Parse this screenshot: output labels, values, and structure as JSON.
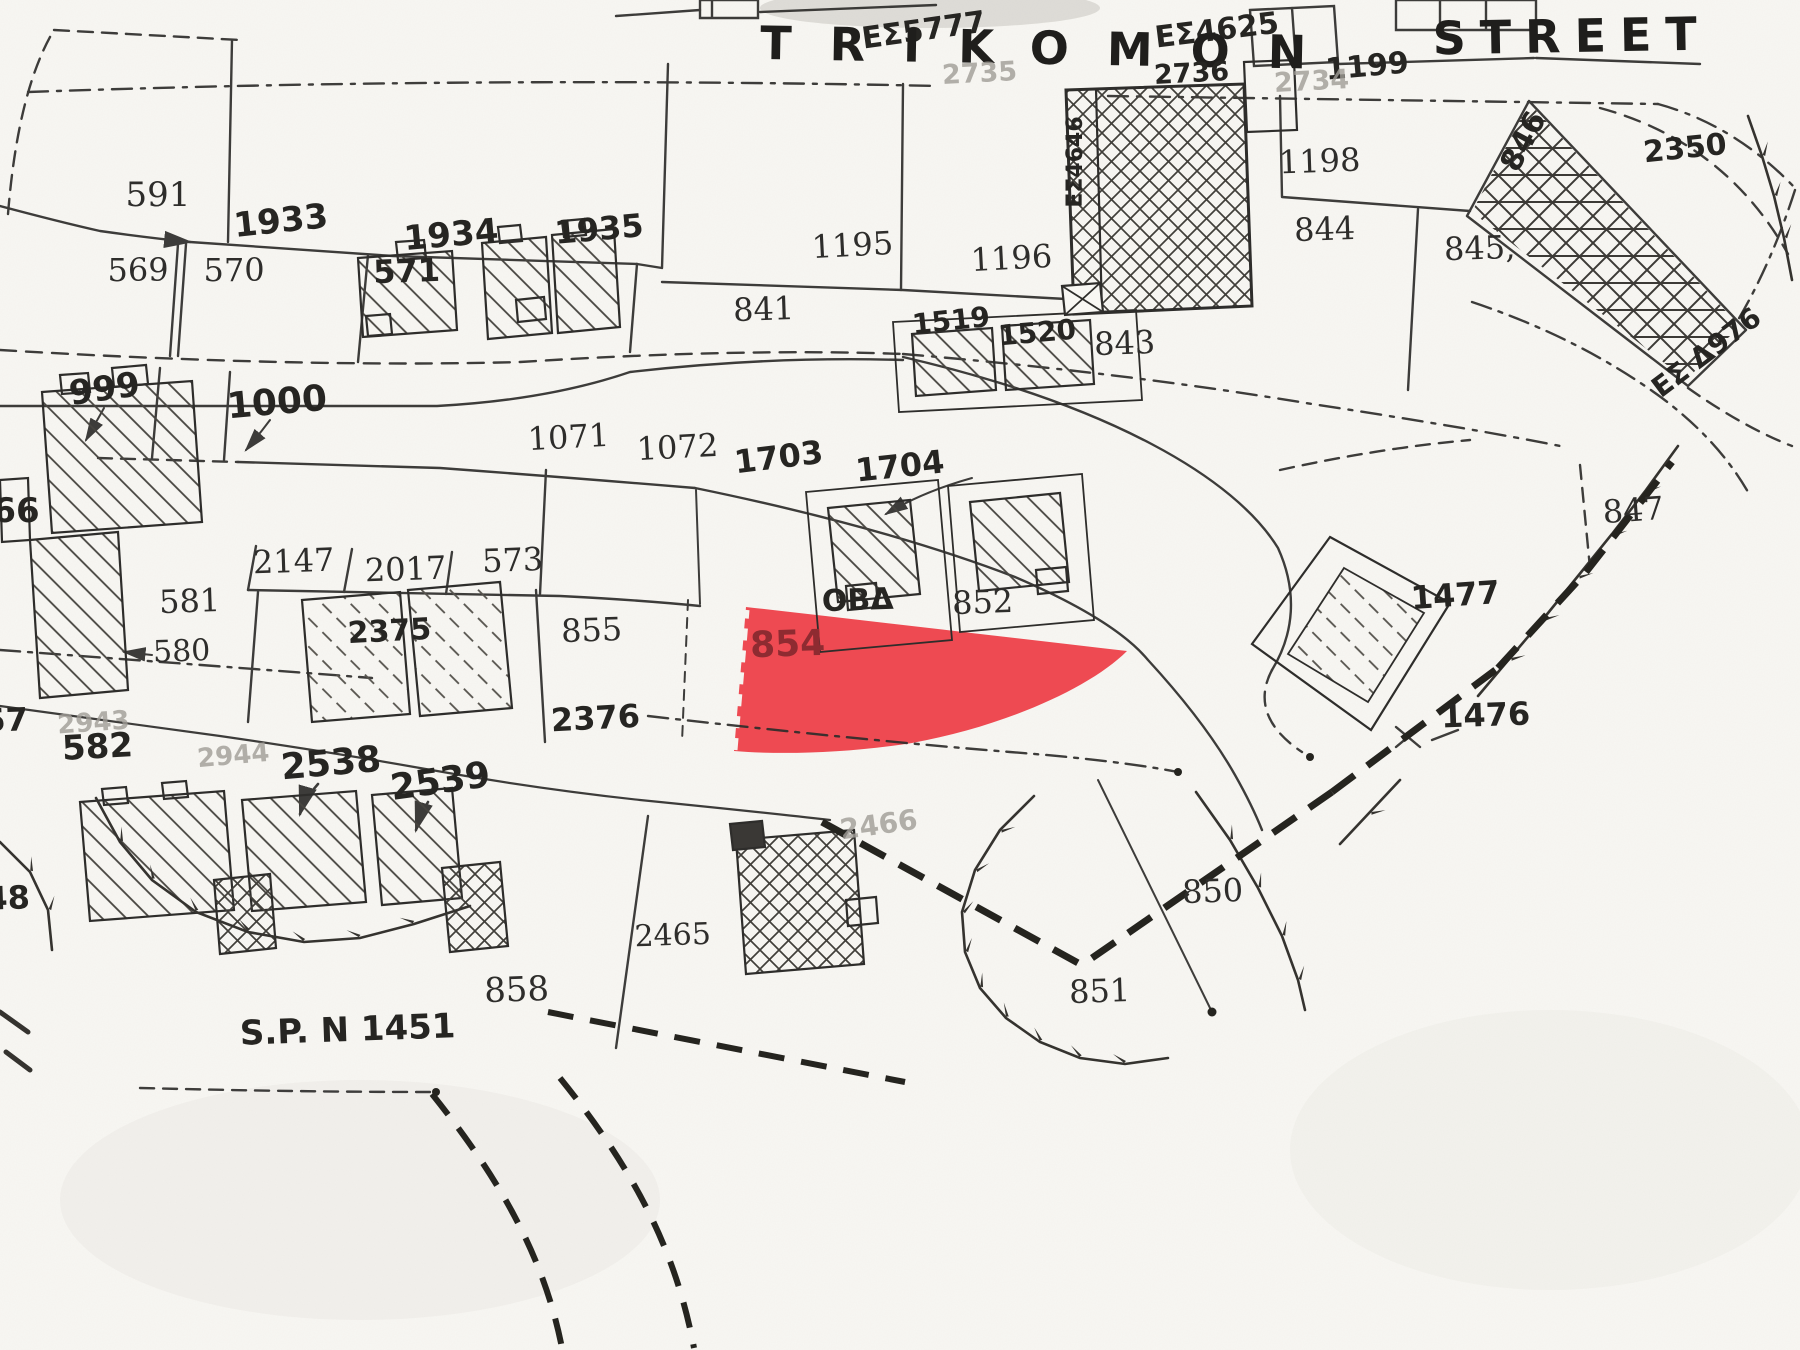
{
  "map": {
    "type": "cadastral-survey-plan",
    "street": {
      "name": "TRIKOMON STREET",
      "word1": "TRIKOMON",
      "word2": "STREET",
      "plot_between_words": "1199"
    },
    "survey_plan_ref": "S.P. N 1451",
    "highlight": {
      "plot_number": "854",
      "fill": "#ee4a52",
      "label_color": "#8e2b31"
    },
    "annotations": [
      "ΕΣ5777",
      "ΕΣ4625",
      "ΕΣ4646",
      "ΕΣ Δ976"
    ],
    "faint_plot_numbers": [
      "2735",
      "2734",
      "2943",
      "2944",
      "2466"
    ],
    "labels": [
      {
        "t": "ΕΣ5777",
        "x": 925,
        "y": 40,
        "r": -8,
        "c": "hand",
        "s": 30
      },
      {
        "t": "ΕΣ4625",
        "x": 1218,
        "y": 40,
        "r": -7,
        "c": "hand",
        "s": 30
      },
      {
        "t": "TRIKOMON",
        "x": 1052,
        "y": 64,
        "r": 1,
        "c": "street",
        "s": 46,
        "ls": 38
      },
      {
        "t": "1199",
        "x": 1368,
        "y": 76,
        "r": -5,
        "c": "hand",
        "s": 30
      },
      {
        "t": "STREET",
        "x": 1572,
        "y": 52,
        "r": -1,
        "c": "street",
        "s": 46,
        "ls": 14
      },
      {
        "t": "2735",
        "x": 980,
        "y": 82,
        "r": -3,
        "c": "faint",
        "s": 27
      },
      {
        "t": "2736",
        "x": 1192,
        "y": 82,
        "r": -3,
        "c": "hand",
        "s": 27
      },
      {
        "t": "2734",
        "x": 1312,
        "y": 90,
        "r": -3,
        "c": "faint",
        "s": 27
      },
      {
        "t": "591",
        "x": 158,
        "y": 206,
        "r": 0,
        "c": "print",
        "s": 34
      },
      {
        "t": "1933",
        "x": 282,
        "y": 232,
        "r": -6,
        "c": "hand",
        "s": 34
      },
      {
        "t": "1934",
        "x": 452,
        "y": 246,
        "r": -5,
        "c": "hand",
        "s": 34
      },
      {
        "t": "1935",
        "x": 600,
        "y": 240,
        "r": -5,
        "c": "hand",
        "s": 32
      },
      {
        "t": "569",
        "x": 138,
        "y": 281,
        "r": 0,
        "c": "print",
        "s": 32
      },
      {
        "t": "570",
        "x": 234,
        "y": 281,
        "r": 0,
        "c": "print",
        "s": 32
      },
      {
        "t": "571",
        "x": 407,
        "y": 282,
        "r": -2,
        "c": "hand",
        "s": 32
      },
      {
        "t": "999",
        "x": 106,
        "y": 400,
        "r": -8,
        "c": "hand",
        "s": 34
      },
      {
        "t": "1000",
        "x": 278,
        "y": 414,
        "r": -5,
        "c": "hand",
        "s": 36
      },
      {
        "t": "1195",
        "x": 853,
        "y": 256,
        "r": -3,
        "c": "print",
        "s": 32
      },
      {
        "t": "1196",
        "x": 1012,
        "y": 269,
        "r": -3,
        "c": "print",
        "s": 32
      },
      {
        "t": "841",
        "x": 764,
        "y": 320,
        "r": -2,
        "c": "print",
        "s": 32
      },
      {
        "t": "1519",
        "x": 952,
        "y": 330,
        "r": -6,
        "c": "hand",
        "s": 28
      },
      {
        "t": "1520",
        "x": 1038,
        "y": 342,
        "r": -5,
        "c": "hand",
        "s": 28
      },
      {
        "t": "843",
        "x": 1125,
        "y": 354,
        "r": -2,
        "c": "print",
        "s": 32
      },
      {
        "t": "1198",
        "x": 1320,
        "y": 172,
        "r": -2,
        "c": "print",
        "s": 32
      },
      {
        "t": "844",
        "x": 1325,
        "y": 240,
        "r": -2,
        "c": "print",
        "s": 32
      },
      {
        "t": "845,",
        "x": 1480,
        "y": 259,
        "r": -2,
        "c": "print",
        "s": 32
      },
      {
        "t": "846",
        "x": 1532,
        "y": 146,
        "r": -62,
        "c": "hand",
        "s": 30
      },
      {
        "t": "2350",
        "x": 1686,
        "y": 158,
        "r": -6,
        "c": "hand",
        "s": 30
      },
      {
        "t": "ΕΣ Δ976",
        "x": 1712,
        "y": 360,
        "r": -37,
        "c": "hand",
        "s": 28
      },
      {
        "t": "ΕΣ4646",
        "x": 1082,
        "y": 162,
        "r": -90,
        "c": "hand",
        "s": 22
      },
      {
        "t": "66",
        "x": 16,
        "y": 522,
        "r": 0,
        "c": "hand",
        "s": 34
      },
      {
        "t": "2147",
        "x": 294,
        "y": 572,
        "r": -2,
        "c": "print",
        "s": 32
      },
      {
        "t": "2017",
        "x": 406,
        "y": 580,
        "r": -2,
        "c": "print",
        "s": 32
      },
      {
        "t": "573",
        "x": 513,
        "y": 571,
        "r": -2,
        "c": "print",
        "s": 32
      },
      {
        "t": "1071",
        "x": 569,
        "y": 448,
        "r": -3,
        "c": "print",
        "s": 32
      },
      {
        "t": "1072",
        "x": 678,
        "y": 458,
        "r": -3,
        "c": "print",
        "s": 32
      },
      {
        "t": "1703",
        "x": 780,
        "y": 468,
        "r": -7,
        "c": "hand",
        "s": 32
      },
      {
        "t": "1704",
        "x": 901,
        "y": 477,
        "r": -6,
        "c": "hand",
        "s": 32
      },
      {
        "t": "847",
        "x": 1634,
        "y": 521,
        "r": -4,
        "c": "print",
        "s": 32
      },
      {
        "t": "1477",
        "x": 1456,
        "y": 606,
        "r": -4,
        "c": "hand",
        "s": 32
      },
      {
        "t": "581",
        "x": 190,
        "y": 612,
        "r": -2,
        "c": "print",
        "s": 32
      },
      {
        "t": "580",
        "x": 182,
        "y": 661,
        "r": -2,
        "c": "print",
        "s": 30
      },
      {
        "t": "2375",
        "x": 390,
        "y": 641,
        "r": -3,
        "c": "hand",
        "s": 30
      },
      {
        "t": "855",
        "x": 592,
        "y": 641,
        "r": -2,
        "c": "print",
        "s": 32
      },
      {
        "t": "ΟΒΔ",
        "x": 858,
        "y": 610,
        "r": -2,
        "c": "hand",
        "s": 30
      },
      {
        "t": "852",
        "x": 983,
        "y": 613,
        "r": -2,
        "c": "print",
        "s": 32
      },
      {
        "t": "854",
        "x": 788,
        "y": 656,
        "r": -2,
        "c": "red",
        "s": 36
      },
      {
        "t": "57",
        "x": 6,
        "y": 731,
        "r": -2,
        "c": "hand",
        "s": 32
      },
      {
        "t": "2943",
        "x": 94,
        "y": 731,
        "r": -4,
        "c": "faint",
        "s": 26
      },
      {
        "t": "582",
        "x": 98,
        "y": 758,
        "r": -3,
        "c": "hand",
        "s": 34
      },
      {
        "t": "2944",
        "x": 234,
        "y": 764,
        "r": -5,
        "c": "faint",
        "s": 26
      },
      {
        "t": "2376",
        "x": 596,
        "y": 729,
        "r": -3,
        "c": "hand",
        "s": 32
      },
      {
        "t": "2538",
        "x": 332,
        "y": 775,
        "r": -5,
        "c": "hand",
        "s": 36
      },
      {
        "t": "2539",
        "x": 442,
        "y": 793,
        "r": -8,
        "c": "hand",
        "s": 36
      },
      {
        "t": "1476",
        "x": 1486,
        "y": 726,
        "r": -2,
        "c": "hand",
        "s": 32
      },
      {
        "t": "48",
        "x": 8,
        "y": 909,
        "r": -2,
        "c": "hand",
        "s": 32
      },
      {
        "t": "858",
        "x": 517,
        "y": 1001,
        "r": -2,
        "c": "print",
        "s": 34
      },
      {
        "t": "2465",
        "x": 673,
        "y": 945,
        "r": -2,
        "c": "print",
        "s": 30
      },
      {
        "t": "2466",
        "x": 880,
        "y": 834,
        "r": -8,
        "c": "faint",
        "s": 28
      },
      {
        "t": "850",
        "x": 1213,
        "y": 902,
        "r": -2,
        "c": "print",
        "s": 32
      },
      {
        "t": "851",
        "x": 1100,
        "y": 1002,
        "r": -2,
        "c": "print",
        "s": 32
      },
      {
        "t": "S.P. N 1451",
        "x": 348,
        "y": 1041,
        "r": -2,
        "c": "hand",
        "s": 34
      }
    ]
  }
}
